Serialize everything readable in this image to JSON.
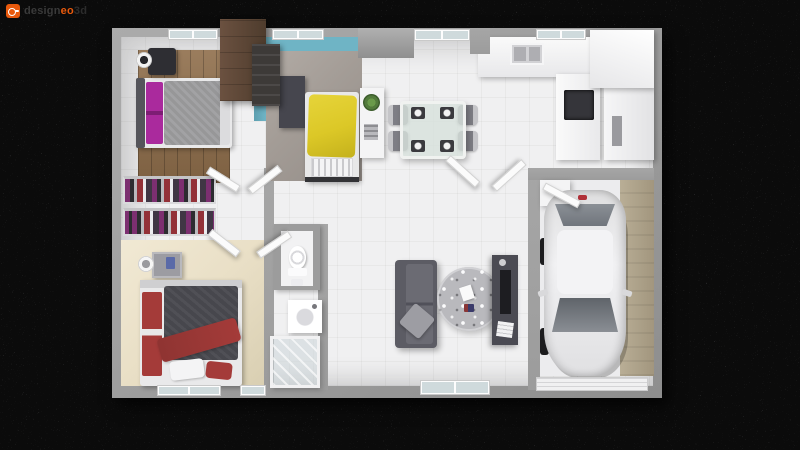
{
  "logo": {
    "icon": "designeo-mark-icon",
    "design": "design",
    "eo": "eo",
    "suffix": "3d"
  },
  "scene": {
    "type": "3d-floor-plan-render",
    "rooms": [
      "bedroom-1",
      "bedroom-2",
      "bedroom-3",
      "dressing-closet",
      "wc",
      "bathroom",
      "kitchen",
      "dining-area",
      "living-room",
      "entry-hall",
      "garage"
    ],
    "furniture": [
      "double-bed-gray-purple",
      "single-bed-yellow",
      "double-bed-red-gray",
      "wardrobe",
      "clothes-rails",
      "nightstands",
      "lamps",
      "dining-table-4-chairs",
      "sideboard-with-plant",
      "sofa",
      "round-rug",
      "tv-cabinet",
      "kitchen-counter-sink-cooktop",
      "tall-cabinets",
      "toilet",
      "vanity-sink",
      "shower",
      "car",
      "storage-shelf"
    ]
  },
  "colors": {
    "background": "#0b0b0b",
    "wall": "#9c9c9c",
    "floor": "#f0f0f1",
    "wood": "#8f6e4b",
    "teal": "#6fb4c5",
    "bedroom2_floor": "#a39c96",
    "yellow": "#dcc827",
    "magenta": "#aa2a9d",
    "beige": "#e9dfc6",
    "red": "#a43b39",
    "duvet_dark": "#47474d",
    "gray_duvet": "#a2a2a4",
    "sofa": "#5c5c64",
    "rug": "#b9b9bd",
    "tv_unit": "#4b4b53",
    "concrete": "#b4a88f",
    "cooktop": "#35353a",
    "wardrobe": "#5f4a39",
    "glass": "#cfdadc",
    "chair": "#7e7e85",
    "plant": "#527a3b",
    "car_glass": "#70757c",
    "logo_orange": "#e8590c",
    "logo_text": "#3a3a3a",
    "logo_text_dim": "#2c2c2c"
  }
}
